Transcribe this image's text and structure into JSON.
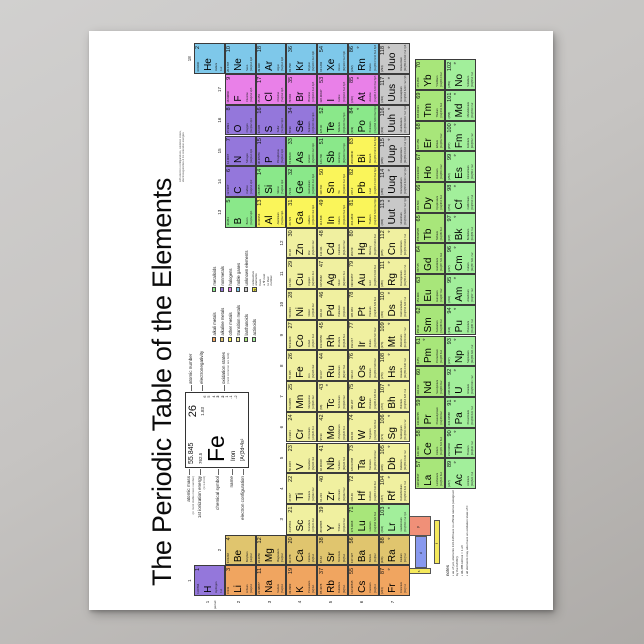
{
  "title": "The Periodic Table of the Elements",
  "subtitle_lines": [
    "with electron configurations, oxidation states,",
    "electronegativities & 1st ionization energies"
  ],
  "axis": {
    "period_word": "period",
    "group_numbers": [
      1,
      2,
      3,
      4,
      5,
      6,
      7,
      8,
      9,
      10,
      11,
      12,
      13,
      14,
      15,
      16,
      17,
      18
    ],
    "period_numbers": [
      1,
      2,
      3,
      4,
      5,
      6,
      7
    ]
  },
  "category_colors": {
    "ak": "#F0A560",
    "ae": "#E0C56E",
    "om": "#FAF55A",
    "tm": "#F0F0A0",
    "la": "#A8E67A",
    "ac": "#A2EF9B",
    "md": "#8AE88A",
    "nm": "#9477DB",
    "hg": "#E980E8",
    "ng": "#7EC8EA",
    "uk": "#C8C8C8"
  },
  "legend": {
    "col1": [
      [
        "alkali metals",
        "ak"
      ],
      [
        "alkaline metals",
        "ae"
      ],
      [
        "other metals",
        "om"
      ],
      [
        "transition metals",
        "tm"
      ],
      [
        "lanthanoids",
        "la"
      ],
      [
        "actinoids",
        "ac"
      ]
    ],
    "col2": [
      [
        "metalloids",
        "md"
      ],
      [
        "nonmetals",
        "nm"
      ],
      [
        "halogens",
        "hg"
      ],
      [
        "noble gases",
        "ng"
      ],
      [
        "unknown elements",
        "uk"
      ]
    ],
    "radioactive_symbol": "☢",
    "radioactive_note_lines": [
      "radioactive elements have",
      "a ☢ next to their number"
    ]
  },
  "featured": {
    "number": "26",
    "symbol": "Fe",
    "name": "Iron",
    "mass": "55.845",
    "ionization": "762.5",
    "electronegativity": "1.83",
    "config": "[Ar]3d⁶4s²",
    "oxidation": [
      "6",
      "5",
      "4",
      "3",
      "2",
      "1",
      "-1",
      "-2"
    ],
    "oxidation_bold": [
      "3",
      "2"
    ],
    "callouts_left": [
      {
        "label": "atomic mass",
        "sub": "(or most stable mass number)"
      },
      {
        "label": "1st ionization energy",
        "sub": "(in kJ/mol)"
      },
      {
        "label": "chemical symbol",
        "sub": ""
      },
      {
        "label": "name",
        "sub": ""
      },
      {
        "label": "electron configuration",
        "sub": ""
      }
    ],
    "callouts_right": [
      {
        "label": "atomic number",
        "sub": ""
      },
      {
        "label": "electronegativity",
        "sub": ""
      },
      {
        "label": "oxidation states",
        "sub": "(most common are bold)"
      }
    ]
  },
  "blocks": {
    "label": "electron configuration blocks",
    "letters": {
      "s": "s",
      "d": "d",
      "p": "p",
      "f": "f"
    },
    "colors": {
      "s": "#F5E95C",
      "d": "#8899EE",
      "p": "#F09078",
      "f": "#F5E95C"
    }
  },
  "notes": {
    "title": "notes",
    "items": [
      "as of yet, elements 113-118 have no official names (assigned by the IUPAC)",
      "96.485 kJ/mol = 1 eV",
      "all elements may also have an oxidation state of 0"
    ]
  },
  "radioactive_numbers": [
    43,
    61,
    "84 and above"
  ],
  "elements": [
    [
      1,
      "H",
      "Hydrogen",
      "1.00794",
      "nm",
      1,
      1,
      "1s1"
    ],
    [
      2,
      "He",
      "Helium",
      "4.00260",
      "ng",
      1,
      18,
      "1s2"
    ],
    [
      3,
      "Li",
      "Lithium",
      "6.941",
      "ak",
      2,
      1,
      "[He]2s1"
    ],
    [
      4,
      "Be",
      "Beryllium",
      "9.01218",
      "ae",
      2,
      2,
      "[He]2s2"
    ],
    [
      5,
      "B",
      "Boron",
      "10.811",
      "md",
      2,
      13,
      "[He]2s2 2p1"
    ],
    [
      6,
      "C",
      "Carbon",
      "12.0107",
      "nm",
      2,
      14,
      "[He]2s2 2p2"
    ],
    [
      7,
      "N",
      "Nitrogen",
      "14.0067",
      "nm",
      2,
      15,
      "[He]2s2 2p3"
    ],
    [
      8,
      "O",
      "Oxygen",
      "15.9994",
      "nm",
      2,
      16,
      "[He]2s2 2p4"
    ],
    [
      9,
      "F",
      "Fluorine",
      "18.99840",
      "hg",
      2,
      17,
      "[He]2s2 2p5"
    ],
    [
      10,
      "Ne",
      "Neon",
      "20.1797",
      "ng",
      2,
      18,
      "[He]2s2 2p6"
    ],
    [
      11,
      "Na",
      "Sodium",
      "22.98977",
      "ak",
      3,
      1,
      "[Ne]3s1"
    ],
    [
      12,
      "Mg",
      "Magnesium",
      "24.3050",
      "ae",
      3,
      2,
      "[Ne]3s2"
    ],
    [
      13,
      "Al",
      "Aluminium",
      "26.98154",
      "om",
      3,
      13,
      "[Ne]3s2 3p1"
    ],
    [
      14,
      "Si",
      "Silicon",
      "28.0855",
      "md",
      3,
      14,
      "[Ne]3s2 3p2"
    ],
    [
      15,
      "P",
      "Phosphorus",
      "30.97376",
      "nm",
      3,
      15,
      "[Ne]3s2 3p3"
    ],
    [
      16,
      "S",
      "Sulfur",
      "32.065",
      "nm",
      3,
      16,
      "[Ne]3s2 3p4"
    ],
    [
      17,
      "Cl",
      "Chlorine",
      "35.453",
      "hg",
      3,
      17,
      "[Ne]3s2 3p5"
    ],
    [
      18,
      "Ar",
      "Argon",
      "39.948",
      "ng",
      3,
      18,
      "[Ne]3s2 3p6"
    ],
    [
      19,
      "K",
      "Potassium",
      "39.0983",
      "ak",
      4,
      1,
      "[Ar]4s1"
    ],
    [
      20,
      "Ca",
      "Calcium",
      "40.078",
      "ae",
      4,
      2,
      "[Ar]4s2"
    ],
    [
      21,
      "Sc",
      "Scandium",
      "44.95591",
      "tm",
      4,
      3,
      "[Ar]3d1 4s2"
    ],
    [
      22,
      "Ti",
      "Titanium",
      "47.867",
      "tm",
      4,
      4,
      "[Ar]3d2 4s2"
    ],
    [
      23,
      "V",
      "Vanadium",
      "50.9415",
      "tm",
      4,
      5,
      "[Ar]3d3 4s2"
    ],
    [
      24,
      "Cr",
      "Chromium",
      "51.9961",
      "tm",
      4,
      6,
      "[Ar]3d5 4s1"
    ],
    [
      25,
      "Mn",
      "Manganese",
      "54.93805",
      "tm",
      4,
      7,
      "[Ar]3d5 4s2"
    ],
    [
      26,
      "Fe",
      "Iron",
      "55.845",
      "tm",
      4,
      8,
      "[Ar]3d6 4s2"
    ],
    [
      27,
      "Co",
      "Cobalt",
      "58.93320",
      "tm",
      4,
      9,
      "[Ar]3d7 4s2"
    ],
    [
      28,
      "Ni",
      "Nickel",
      "58.6934",
      "tm",
      4,
      10,
      "[Ar]3d8 4s2"
    ],
    [
      29,
      "Cu",
      "Copper",
      "63.546",
      "tm",
      4,
      11,
      "[Ar]3d10 4s1"
    ],
    [
      30,
      "Zn",
      "Zinc",
      "65.38",
      "tm",
      4,
      12,
      "[Ar]3d10 4s2"
    ],
    [
      31,
      "Ga",
      "Gallium",
      "69.723",
      "om",
      4,
      13,
      "[Ar]3d10 4s2 4p1"
    ],
    [
      32,
      "Ge",
      "Germanium",
      "72.64",
      "md",
      4,
      14,
      "[Ar]3d10 4s2 4p2"
    ],
    [
      33,
      "As",
      "Arsenic",
      "74.92160",
      "md",
      4,
      15,
      "[Ar]3d10 4s2 4p3"
    ],
    [
      34,
      "Se",
      "Selenium",
      "78.96",
      "nm",
      4,
      16,
      "[Ar]3d10 4s2 4p4"
    ],
    [
      35,
      "Br",
      "Bromine",
      "79.904",
      "hg",
      4,
      17,
      "[Ar]3d10 4s2 4p5"
    ],
    [
      36,
      "Kr",
      "Krypton",
      "83.798",
      "ng",
      4,
      18,
      "[Ar]3d10 4s2 4p6"
    ],
    [
      37,
      "Rb",
      "Rubidium",
      "85.4678",
      "ak",
      5,
      1,
      "[Kr]5s1"
    ],
    [
      38,
      "Sr",
      "Strontium",
      "87.62",
      "ae",
      5,
      2,
      "[Kr]5s2"
    ],
    [
      39,
      "Y",
      "Yttrium",
      "88.90585",
      "tm",
      5,
      3,
      "[Kr]4d1 5s2"
    ],
    [
      40,
      "Zr",
      "Zirconium",
      "91.224",
      "tm",
      5,
      4,
      "[Kr]4d2 5s2"
    ],
    [
      41,
      "Nb",
      "Niobium",
      "92.90638",
      "tm",
      5,
      5,
      "[Kr]4d4 5s1"
    ],
    [
      42,
      "Mo",
      "Molybdenum",
      "95.96",
      "tm",
      5,
      6,
      "[Kr]4d5 5s1"
    ],
    [
      43,
      "Tc",
      "Technetium",
      "(98)",
      "tm",
      5,
      7,
      "[Kr]4d5 5s2"
    ],
    [
      44,
      "Ru",
      "Ruthenium",
      "101.07",
      "tm",
      5,
      8,
      "[Kr]4d7 5s1"
    ],
    [
      45,
      "Rh",
      "Rhodium",
      "102.90550",
      "tm",
      5,
      9,
      "[Kr]4d8 5s1"
    ],
    [
      46,
      "Pd",
      "Palladium",
      "106.42",
      "tm",
      5,
      10,
      "[Kr]4d10"
    ],
    [
      47,
      "Ag",
      "Silver",
      "107.8682",
      "tm",
      5,
      11,
      "[Kr]4d10 5s1"
    ],
    [
      48,
      "Cd",
      "Cadmium",
      "112.411",
      "tm",
      5,
      12,
      "[Kr]4d10 5s2"
    ],
    [
      49,
      "In",
      "Indium",
      "114.818",
      "om",
      5,
      13,
      "[Kr]4d10 5s2 5p1"
    ],
    [
      50,
      "Sn",
      "Tin",
      "118.710",
      "om",
      5,
      14,
      "[Kr]4d10 5s2 5p2"
    ],
    [
      51,
      "Sb",
      "Antimony",
      "121.760",
      "md",
      5,
      15,
      "[Kr]4d10 5s2 5p3"
    ],
    [
      52,
      "Te",
      "Tellurium",
      "127.60",
      "md",
      5,
      16,
      "[Kr]4d10 5s2 5p4"
    ],
    [
      53,
      "I",
      "Iodine",
      "126.90447",
      "hg",
      5,
      17,
      "[Kr]4d10 5s2 5p5"
    ],
    [
      54,
      "Xe",
      "Xenon",
      "131.293",
      "ng",
      5,
      18,
      "[Kr]4d10 5s2 5p6"
    ],
    [
      55,
      "Cs",
      "Caesium",
      "132.90545",
      "ak",
      6,
      1,
      "[Xe]6s1"
    ],
    [
      56,
      "Ba",
      "Barium",
      "137.327",
      "ae",
      6,
      2,
      "[Xe]6s2"
    ],
    [
      71,
      "Lu",
      "Lutetium",
      "174.9668",
      "la",
      6,
      3,
      "[Xe]4f14 5d1 6s2"
    ],
    [
      72,
      "Hf",
      "Hafnium",
      "178.49",
      "tm",
      6,
      4,
      "[Xe]4f14 5d2 6s2"
    ],
    [
      73,
      "Ta",
      "Tantalum",
      "180.94788",
      "tm",
      6,
      5,
      "[Xe]4f14 5d3 6s2"
    ],
    [
      74,
      "W",
      "Tungsten",
      "183.84",
      "tm",
      6,
      6,
      "[Xe]4f14 5d4 6s2"
    ],
    [
      75,
      "Re",
      "Rhenium",
      "186.207",
      "tm",
      6,
      7,
      "[Xe]4f14 5d5 6s2"
    ],
    [
      76,
      "Os",
      "Osmium",
      "190.23",
      "tm",
      6,
      8,
      "[Xe]4f14 5d6 6s2"
    ],
    [
      77,
      "Ir",
      "Iridium",
      "192.217",
      "tm",
      6,
      9,
      "[Xe]4f14 5d7 6s2"
    ],
    [
      78,
      "Pt",
      "Platinum",
      "195.084",
      "tm",
      6,
      10,
      "[Xe]4f14 5d9 6s1"
    ],
    [
      79,
      "Au",
      "Gold",
      "196.96657",
      "tm",
      6,
      11,
      "[Xe]4f14 5d10 6s1"
    ],
    [
      80,
      "Hg",
      "Mercury",
      "200.59",
      "tm",
      6,
      12,
      "[Xe]4f14 5d10 6s2"
    ],
    [
      81,
      "Tl",
      "Thallium",
      "204.3833",
      "om",
      6,
      13,
      "[Xe]4f14 5d10 6s2 6p1"
    ],
    [
      82,
      "Pb",
      "Lead",
      "207.2",
      "om",
      6,
      14,
      "[Xe]4f14 5d10 6s2 6p2"
    ],
    [
      83,
      "Bi",
      "Bismuth",
      "208.98040",
      "om",
      6,
      15,
      "[Xe]4f14 5d10 6s2 6p3"
    ],
    [
      84,
      "Po",
      "Polonium",
      "(209)",
      "md",
      6,
      16,
      "[Xe]4f14 5d10 6s2 6p4"
    ],
    [
      85,
      "At",
      "Astatine",
      "(210)",
      "hg",
      6,
      17,
      "[Xe]4f14 5d10 6s2 6p5"
    ],
    [
      86,
      "Rn",
      "Radon",
      "(222)",
      "ng",
      6,
      18,
      "[Xe]4f14 5d10 6s2 6p6"
    ],
    [
      87,
      "Fr",
      "Francium",
      "(223)",
      "ak",
      7,
      1,
      "[Rn]7s1"
    ],
    [
      88,
      "Ra",
      "Radium",
      "(226)",
      "ae",
      7,
      2,
      "[Rn]7s2"
    ],
    [
      103,
      "Lr",
      "Lawrencium",
      "(262)",
      "ac",
      7,
      3,
      "[Rn]5f14 7s2 7p1"
    ],
    [
      104,
      "Rf",
      "Rutherfordium",
      "(267)",
      "tm",
      7,
      4,
      "[Rn]5f14 6d2 7s2"
    ],
    [
      105,
      "Db",
      "Dubnium",
      "(268)",
      "tm",
      7,
      5,
      "[Rn]5f14 6d3 7s2"
    ],
    [
      106,
      "Sg",
      "Seaborgium",
      "(271)",
      "tm",
      7,
      6,
      "[Rn]5f14 6d4 7s2"
    ],
    [
      107,
      "Bh",
      "Bohrium",
      "(272)",
      "tm",
      7,
      7,
      "[Rn]5f14 6d5 7s2"
    ],
    [
      108,
      "Hs",
      "Hassium",
      "(270)",
      "tm",
      7,
      8,
      "[Rn]5f14 6d6 7s2"
    ],
    [
      109,
      "Mt",
      "Meitnerium",
      "(276)",
      "tm",
      7,
      9,
      "[Rn]5f14 6d7 7s2"
    ],
    [
      110,
      "Ds",
      "Darmstadtium",
      "(281)",
      "tm",
      7,
      10,
      "[Rn]5f14 6d9 7s1"
    ],
    [
      111,
      "Rg",
      "Roentgenium",
      "(280)",
      "tm",
      7,
      11,
      "[Rn]5f14 6d10 7s1"
    ],
    [
      112,
      "Cn",
      "Copernicium",
      "(285)",
      "tm",
      7,
      12,
      "[Rn]5f14 6d10 7s2"
    ],
    [
      113,
      "Uut",
      "Ununtrium",
      "(284)",
      "uk",
      7,
      13,
      "[Rn]5f14 6d10 7s2 7p1"
    ],
    [
      114,
      "Uuq",
      "Ununquadium",
      "(289)",
      "uk",
      7,
      14,
      "[Rn]5f14 6d10 7s2 7p2"
    ],
    [
      115,
      "Uup",
      "Ununpentium",
      "(288)",
      "uk",
      7,
      15,
      "[Rn]5f14 6d10 7s2 7p3"
    ],
    [
      116,
      "Uuh",
      "Ununhexium",
      "(293)",
      "uk",
      7,
      16,
      "[Rn]5f14 6d10 7s2 7p4"
    ],
    [
      117,
      "Uus",
      "Ununseptium",
      "(294)",
      "uk",
      7,
      17,
      "[Rn]5f14 6d10 7s2 7p5"
    ],
    [
      118,
      "Uuo",
      "Ununoctium",
      "(294)",
      "uk",
      7,
      18,
      "[Rn]5f14 6d10 7s2 7p6"
    ],
    [
      57,
      "La",
      "Lanthanum",
      "138.90547",
      "la",
      8,
      1,
      "[Xe]5d1 6s2"
    ],
    [
      58,
      "Ce",
      "Cerium",
      "140.116",
      "la",
      8,
      2,
      "[Xe]4f1 5d1 6s2"
    ],
    [
      59,
      "Pr",
      "Praseodymium",
      "140.90765",
      "la",
      8,
      3,
      "[Xe]4f3 6s2"
    ],
    [
      60,
      "Nd",
      "Neodymium",
      "144.242",
      "la",
      8,
      4,
      "[Xe]4f4 6s2"
    ],
    [
      61,
      "Pm",
      "Promethium",
      "(145)",
      "la",
      8,
      5,
      "[Xe]4f5 6s2"
    ],
    [
      62,
      "Sm",
      "Samarium",
      "150.36",
      "la",
      8,
      6,
      "[Xe]4f6 6s2"
    ],
    [
      63,
      "Eu",
      "Europium",
      "151.964",
      "la",
      8,
      7,
      "[Xe]4f7 6s2"
    ],
    [
      64,
      "Gd",
      "Gadolinium",
      "157.25",
      "la",
      8,
      8,
      "[Xe]4f7 5d1 6s2"
    ],
    [
      65,
      "Tb",
      "Terbium",
      "158.92535",
      "la",
      8,
      9,
      "[Xe]4f9 6s2"
    ],
    [
      66,
      "Dy",
      "Dysprosium",
      "162.500",
      "la",
      8,
      10,
      "[Xe]4f10 6s2"
    ],
    [
      67,
      "Ho",
      "Holmium",
      "164.93032",
      "la",
      8,
      11,
      "[Xe]4f11 6s2"
    ],
    [
      68,
      "Er",
      "Erbium",
      "167.259",
      "la",
      8,
      12,
      "[Xe]4f12 6s2"
    ],
    [
      69,
      "Tm",
      "Thulium",
      "168.93421",
      "la",
      8,
      13,
      "[Xe]4f13 6s2"
    ],
    [
      70,
      "Yb",
      "Ytterbium",
      "173.054",
      "la",
      8,
      14,
      "[Xe]4f14 6s2"
    ],
    [
      89,
      "Ac",
      "Actinium",
      "(227)",
      "ac",
      9,
      1,
      "[Rn]6d1 7s2"
    ],
    [
      90,
      "Th",
      "Thorium",
      "232.03806",
      "ac",
      9,
      2,
      "[Rn]6d2 7s2"
    ],
    [
      91,
      "Pa",
      "Protactinium",
      "231.03588",
      "ac",
      9,
      3,
      "[Rn]5f2 6d1 7s2"
    ],
    [
      92,
      "U",
      "Uranium",
      "238.02891",
      "ac",
      9,
      4,
      "[Rn]5f3 6d1 7s2"
    ],
    [
      93,
      "Np",
      "Neptunium",
      "(237)",
      "ac",
      9,
      5,
      "[Rn]5f4 6d1 7s2"
    ],
    [
      94,
      "Pu",
      "Plutonium",
      "(244)",
      "ac",
      9,
      6,
      "[Rn]5f6 7s2"
    ],
    [
      95,
      "Am",
      "Americium",
      "(243)",
      "ac",
      9,
      7,
      "[Rn]5f7 7s2"
    ],
    [
      96,
      "Cm",
      "Curium",
      "(247)",
      "ac",
      9,
      8,
      "[Rn]5f7 6d1 7s2"
    ],
    [
      97,
      "Bk",
      "Berkelium",
      "(247)",
      "ac",
      9,
      9,
      "[Rn]5f9 7s2"
    ],
    [
      98,
      "Cf",
      "Californium",
      "(251)",
      "ac",
      9,
      10,
      "[Rn]5f10 7s2"
    ],
    [
      99,
      "Es",
      "Einsteinium",
      "(252)",
      "ac",
      9,
      11,
      "[Rn]5f11 7s2"
    ],
    [
      100,
      "Fm",
      "Fermium",
      "(257)",
      "ac",
      9,
      12,
      "[Rn]5f12 7s2"
    ],
    [
      101,
      "Md",
      "Mendelevium",
      "(258)",
      "ac",
      9,
      13,
      "[Rn]5f13 7s2"
    ],
    [
      102,
      "No",
      "Nobelium",
      "(259)",
      "ac",
      9,
      14,
      "[Rn]5f14 7s2"
    ]
  ]
}
